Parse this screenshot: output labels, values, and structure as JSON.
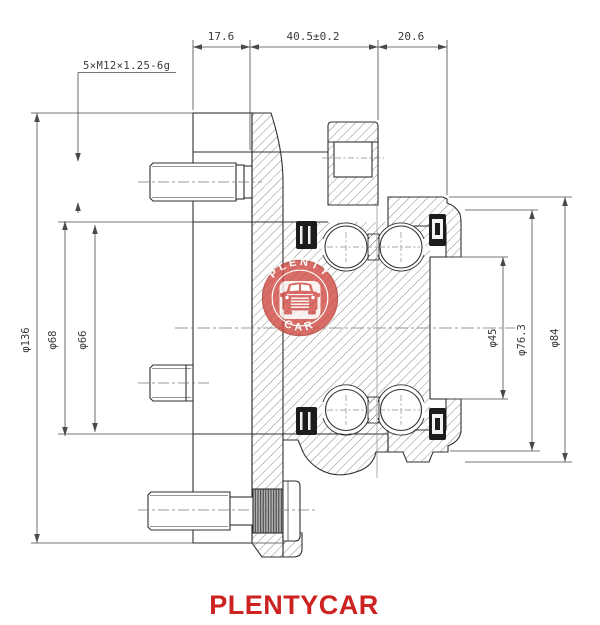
{
  "drawing": {
    "top_dimensions": [
      "17.6",
      "40.5±0.2",
      "20.6"
    ],
    "thread_callout": "5×M12×1.25-6g",
    "left_diameters": [
      "φ136",
      "φ68",
      "φ66"
    ],
    "right_diameters": [
      "φ45",
      "φ76.3",
      "φ84"
    ]
  },
  "stamp": {
    "arc_top": "PLENTY",
    "arc_bottom": "CAR"
  },
  "footer": {
    "brand": "PLENTYCAR"
  },
  "colors": {
    "brand_red": "#cd2222",
    "stamp_red": "#cf4a42",
    "line": "#303030"
  }
}
